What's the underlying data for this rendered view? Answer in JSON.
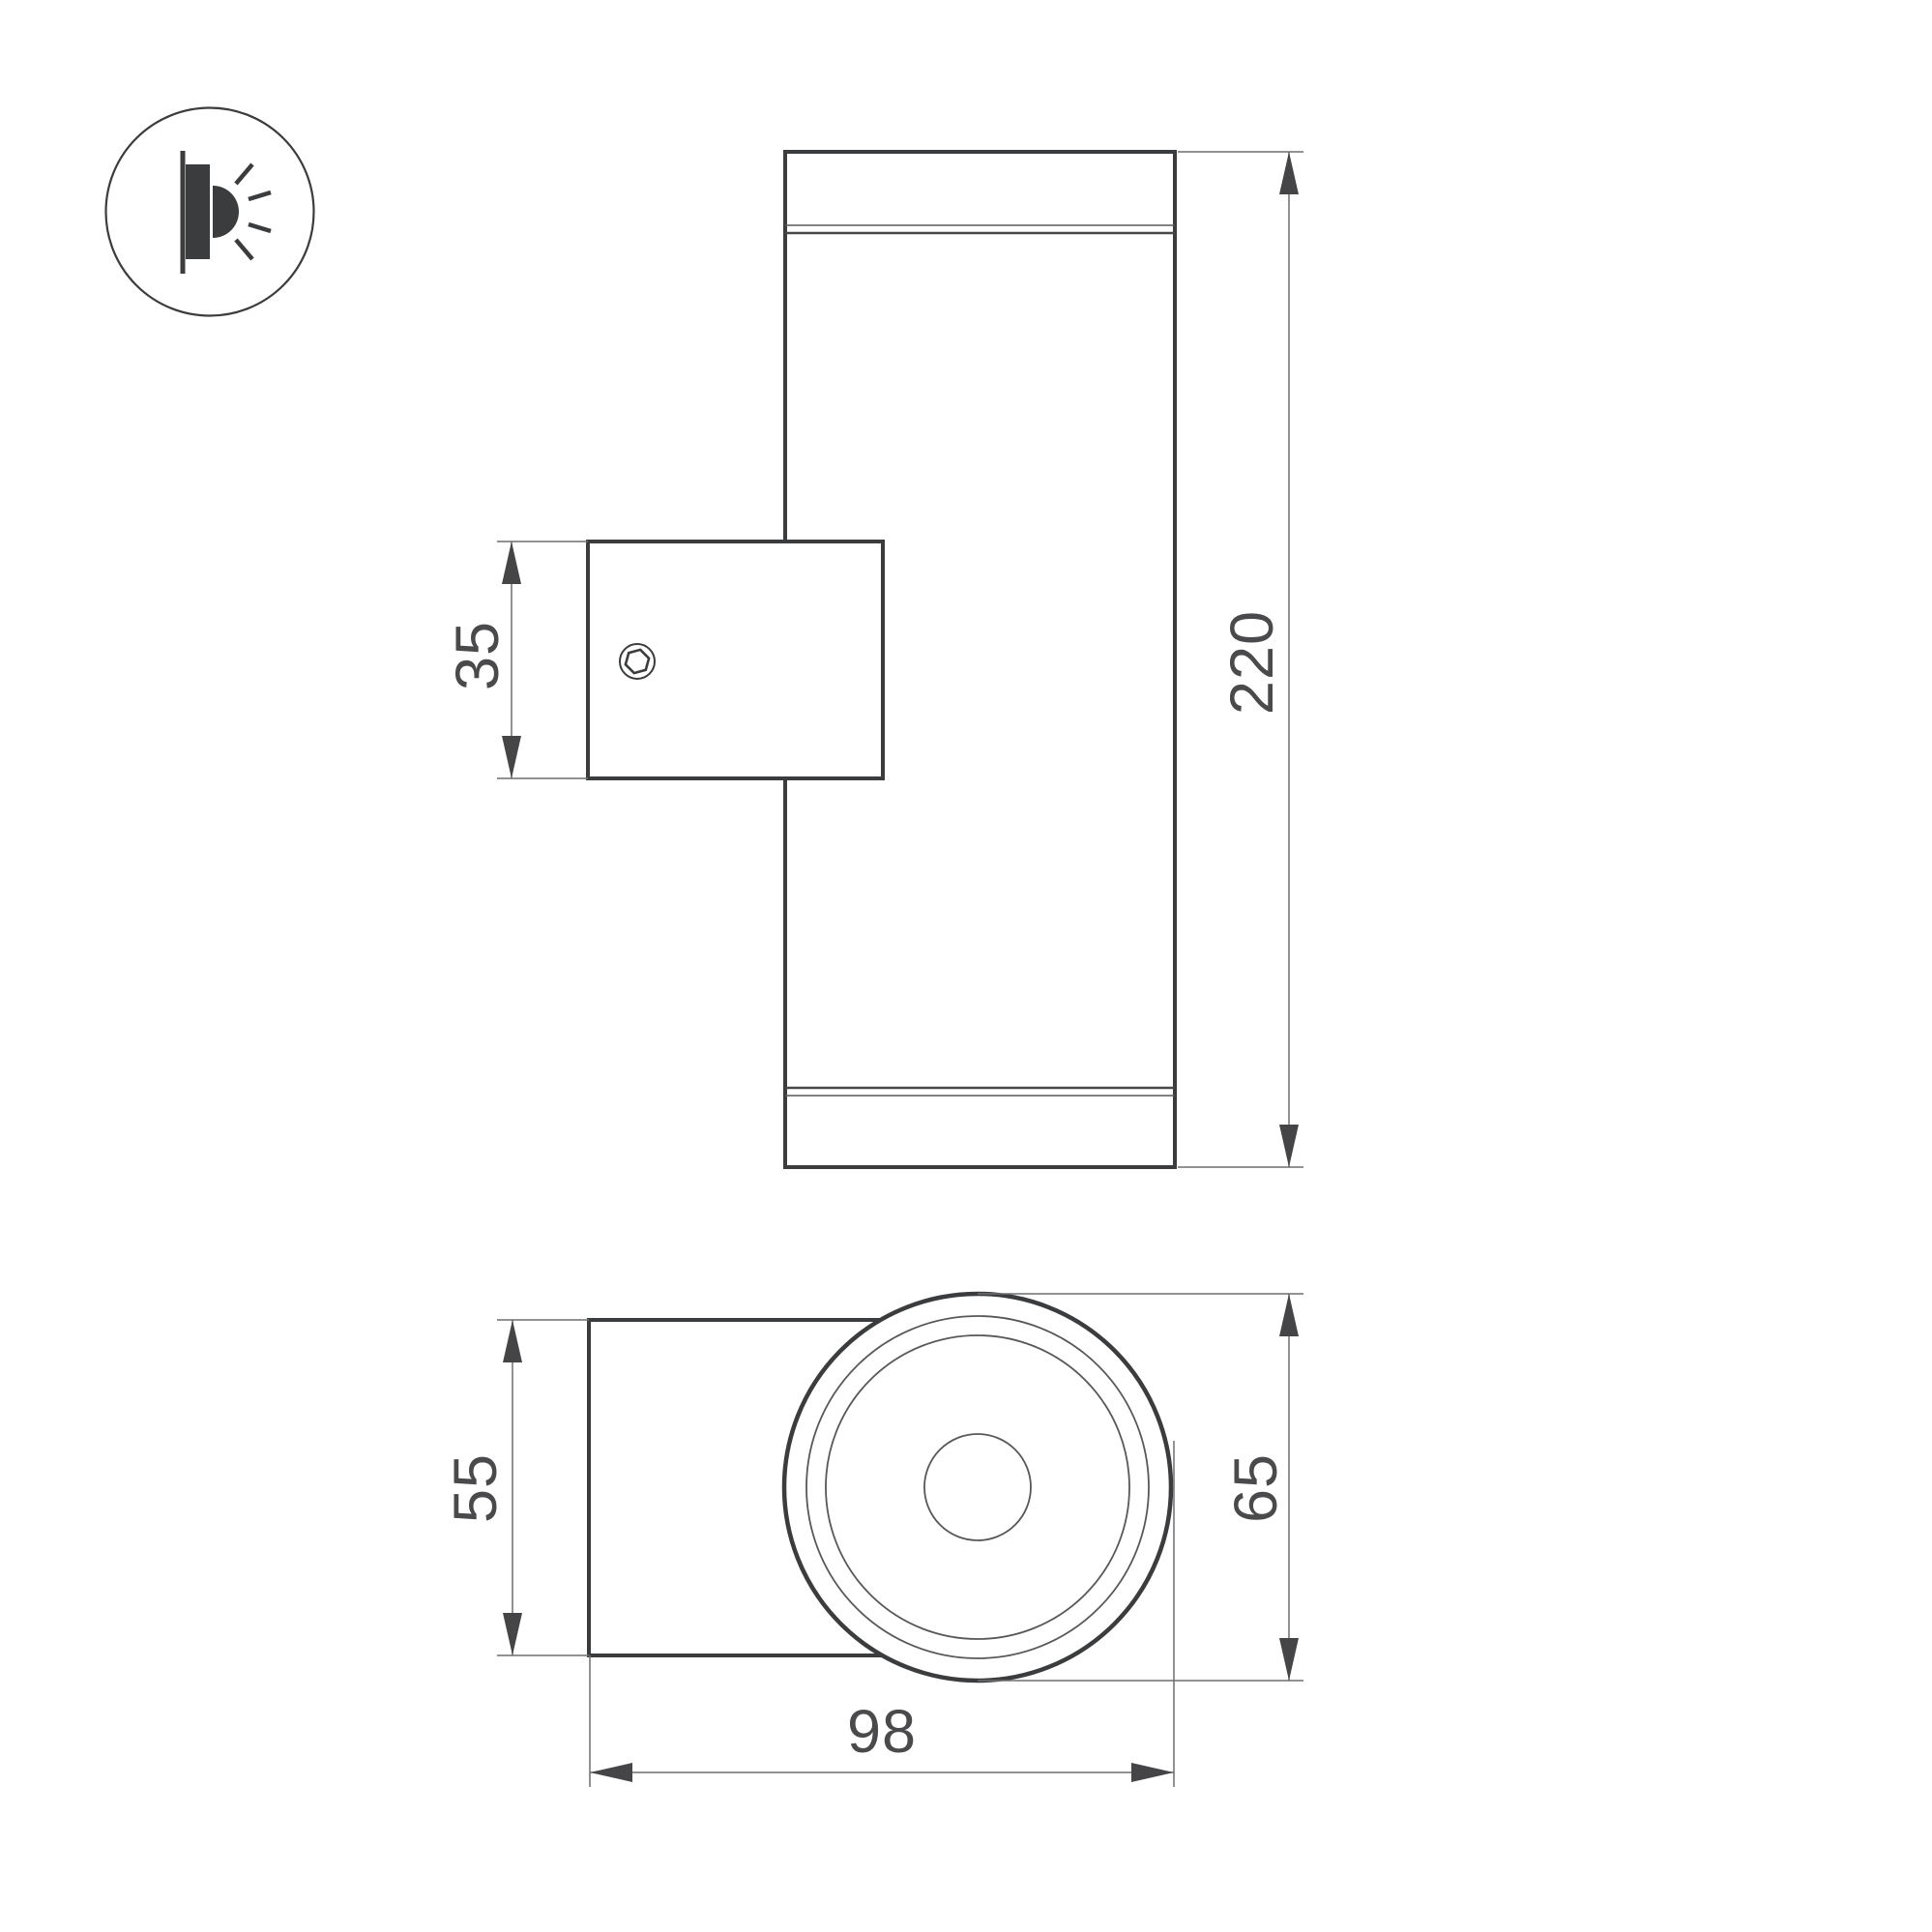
{
  "drawing": {
    "kind": "technical-dimension-drawing",
    "subject": "wall-mounted cylindrical up/down luminaire",
    "dimensions": {
      "bracket_height_mm": "35",
      "total_height_mm": "220",
      "plate_width_mm": "55",
      "body_diameter_mm": "65",
      "total_depth_mm": "98"
    },
    "legend_icon": "wall-light-emission-icon",
    "colors": {
      "background": "#FFFFFF",
      "outline": "#3A3C3E",
      "dimension_lines": "#6E6E70",
      "dimension_text": "#4A4A4C",
      "arrowheads": "#454548"
    }
  }
}
